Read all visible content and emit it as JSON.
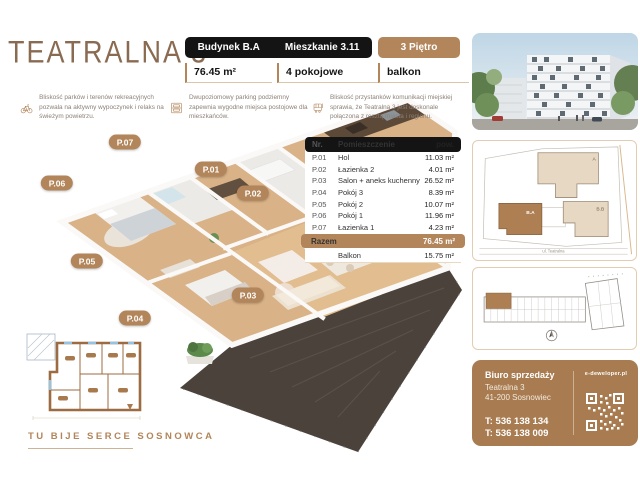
{
  "logo": {
    "title": "TEATRALNA 3"
  },
  "header": {
    "building": "Budynek B.A",
    "apartment": "Mieszkanie 3.11",
    "floor": "3 Piętro",
    "area": "76.45 m²",
    "rooms": "4 pokojowe",
    "feature": "balkon"
  },
  "highlights": [
    {
      "icon": "bicycle-icon",
      "text": "Bliskość parków i terenów rekreacyjnych pozwala na aktywny wypoczynek i relaks na świeżym powietrzu."
    },
    {
      "icon": "parking-icon",
      "text": "Dwupoziomowy parking podziemny zapewnia wygodne miejsca postojowe dla mieszkańców."
    },
    {
      "icon": "bus-icon",
      "text": "Bliskość przystanków komunikacji miejskiej sprawia, że Teatralna 3 jest doskonale połączona z resztą miasta i regionu."
    }
  ],
  "room_table": {
    "col_nr": "Nr.",
    "col_name": "Pomieszczenie",
    "col_area": "pow.",
    "rows": [
      {
        "nr": "P.01",
        "name": "Hol",
        "area": "11.03 m²"
      },
      {
        "nr": "P.02",
        "name": "Łazienka 2",
        "area": "4.01 m²"
      },
      {
        "nr": "P.03",
        "name": "Salon + aneks kuchenny",
        "area": "26.52 m²"
      },
      {
        "nr": "P.04",
        "name": "Pokój 3",
        "area": "8.39 m²"
      },
      {
        "nr": "P.05",
        "name": "Pokój 2",
        "area": "10.07 m²"
      },
      {
        "nr": "P.06",
        "name": "Pokój 1",
        "area": "11.96 m²"
      },
      {
        "nr": "P.07",
        "name": "Łazienka 1",
        "area": "4.23 m²"
      }
    ],
    "total_label": "Razem",
    "total_value": "76.45 m²",
    "balcony_label": "Balkon",
    "balcony_value": "15.75 m²"
  },
  "plan": {
    "labels": [
      "P.01",
      "P.02",
      "P.03",
      "P.04",
      "P.05",
      "P.06",
      "P.07"
    ]
  },
  "site_plan": {
    "building_a": "A",
    "building_bb": "B.B",
    "building_ba": "B.A",
    "street": "ul. Teatralna"
  },
  "contact": {
    "title": "Biuro sprzedaży",
    "address_line1": "Teatralna 3",
    "address_line2": "41-200 Sosnowiec",
    "phone1": "T: 536 138 134",
    "phone2": "T: 536 138 009",
    "website": "e-deweloper.pl"
  },
  "slogan": "TU BIJE SERCE SOSNOWCA",
  "colors": {
    "accent": "#b2855a",
    "dark": "#141414",
    "contact_bg": "#a87c50"
  }
}
